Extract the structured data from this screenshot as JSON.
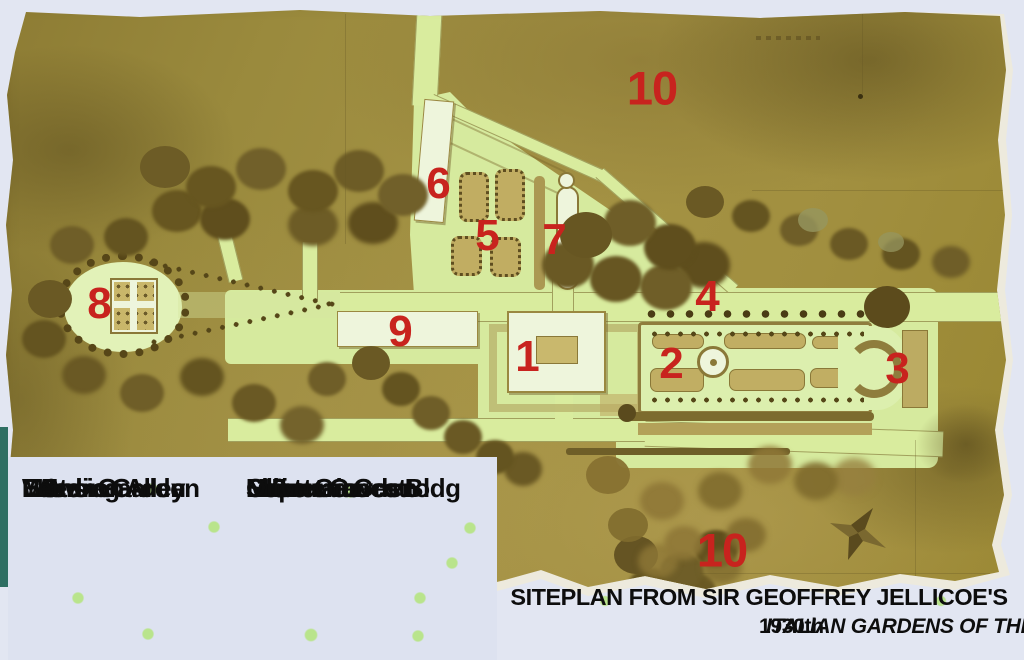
{
  "legend": {
    "items": [
      {
        "number": "1",
        "name": "Mansion"
      },
      {
        "number": "2",
        "name": "Water Garden"
      },
      {
        "number": "3",
        "name": "Exedra"
      },
      {
        "number": "4",
        "name": "Bowling Alley"
      },
      {
        "number": "5",
        "name": "Lemon Garden"
      },
      {
        "number": "6",
        "name": "Limonaia"
      },
      {
        "number": "7",
        "name": "Secret Garden"
      },
      {
        "number": "8",
        "name": "Neptune Grotto"
      },
      {
        "number": "9",
        "name": "Maintenance Bldg"
      },
      {
        "number": "10",
        "name": "Olive Groves"
      }
    ]
  },
  "map_labels": [
    {
      "number": "10",
      "refers_to": "Olive Groves (north)"
    },
    {
      "number": "6",
      "refers_to": "Limonaia"
    },
    {
      "number": "5",
      "refers_to": "Lemon Garden"
    },
    {
      "number": "7",
      "refers_to": "Secret Garden"
    },
    {
      "number": "8",
      "refers_to": "Neptune Grotto"
    },
    {
      "number": "4",
      "refers_to": "Bowling Alley"
    },
    {
      "number": "9",
      "refers_to": "Maintenance Bldg"
    },
    {
      "number": "1",
      "refers_to": "Mansion"
    },
    {
      "number": "2",
      "refers_to": "Water Garden"
    },
    {
      "number": "3",
      "refers_to": "Exedra"
    },
    {
      "number": "10",
      "refers_to": "Olive Groves (south)"
    }
  ],
  "caption": {
    "line1": "SITEPLAN FROM SIR GEOFFREY JELLICOE'S",
    "line2_prefix": "1930th",
    "line2_italic": "ITALIAN GARDENS OF THE RENAISSANCE"
  },
  "icons": {
    "compass_star": "four-pointed-star"
  },
  "colors": {
    "annotation_red": "#c8231e",
    "page_background": "#e2e6f2",
    "legend_background": "#dde2f0",
    "paper_olive": "#9d8c3f",
    "lawn_green": "#d6ea9e",
    "building_white": "#eef5dc",
    "tree_brown": "#6a5924",
    "teal_edge": "#2f6f63"
  }
}
